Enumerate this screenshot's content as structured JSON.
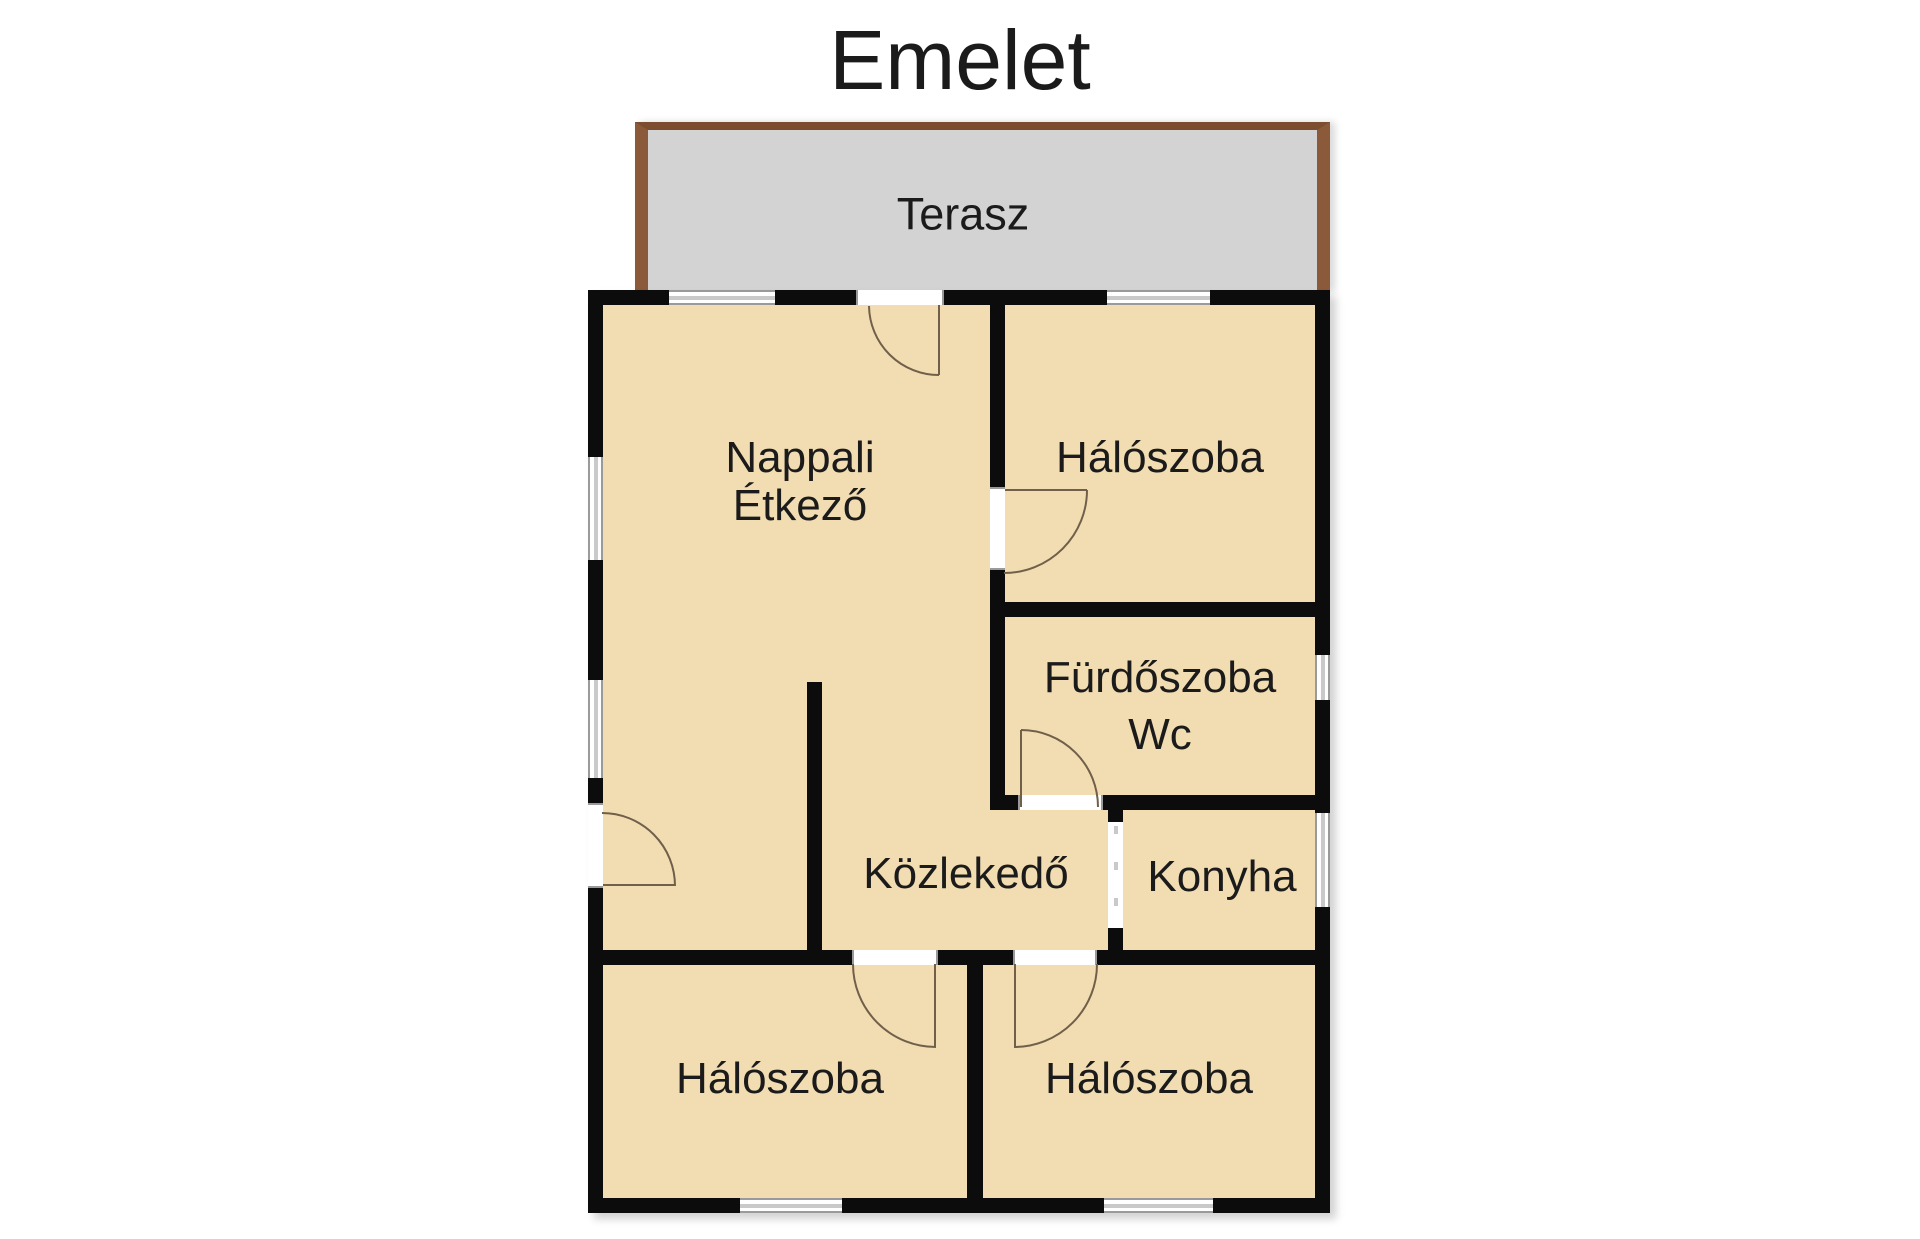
{
  "title": "Emelet",
  "terrace": {
    "label": "Terasz"
  },
  "rooms": {
    "living": {
      "name": "Nappali",
      "name2": "Étkező"
    },
    "bedroom_top": {
      "name": "Hálószoba"
    },
    "bathroom": {
      "line1": "Fürdőszoba",
      "line2": "Wc"
    },
    "hallway": {
      "name": "Közlekedő"
    },
    "kitchen": {
      "name": "Konyha"
    },
    "bedroom_left": {
      "name": "Hálószoba"
    },
    "bedroom_right": {
      "name": "Hálószoba"
    }
  },
  "colors": {
    "wall": "#0c0c0c",
    "room": "#f2dcb2",
    "terr": "#d3d3d3",
    "terrb": "#8a5a3b",
    "terrbt": "#7d4d30",
    "winline": "#9a9a9a",
    "winmid": "#c9c9c9",
    "arc": "#70604a",
    "text": "#1b1b1b",
    "bg": "#ffffff"
  }
}
